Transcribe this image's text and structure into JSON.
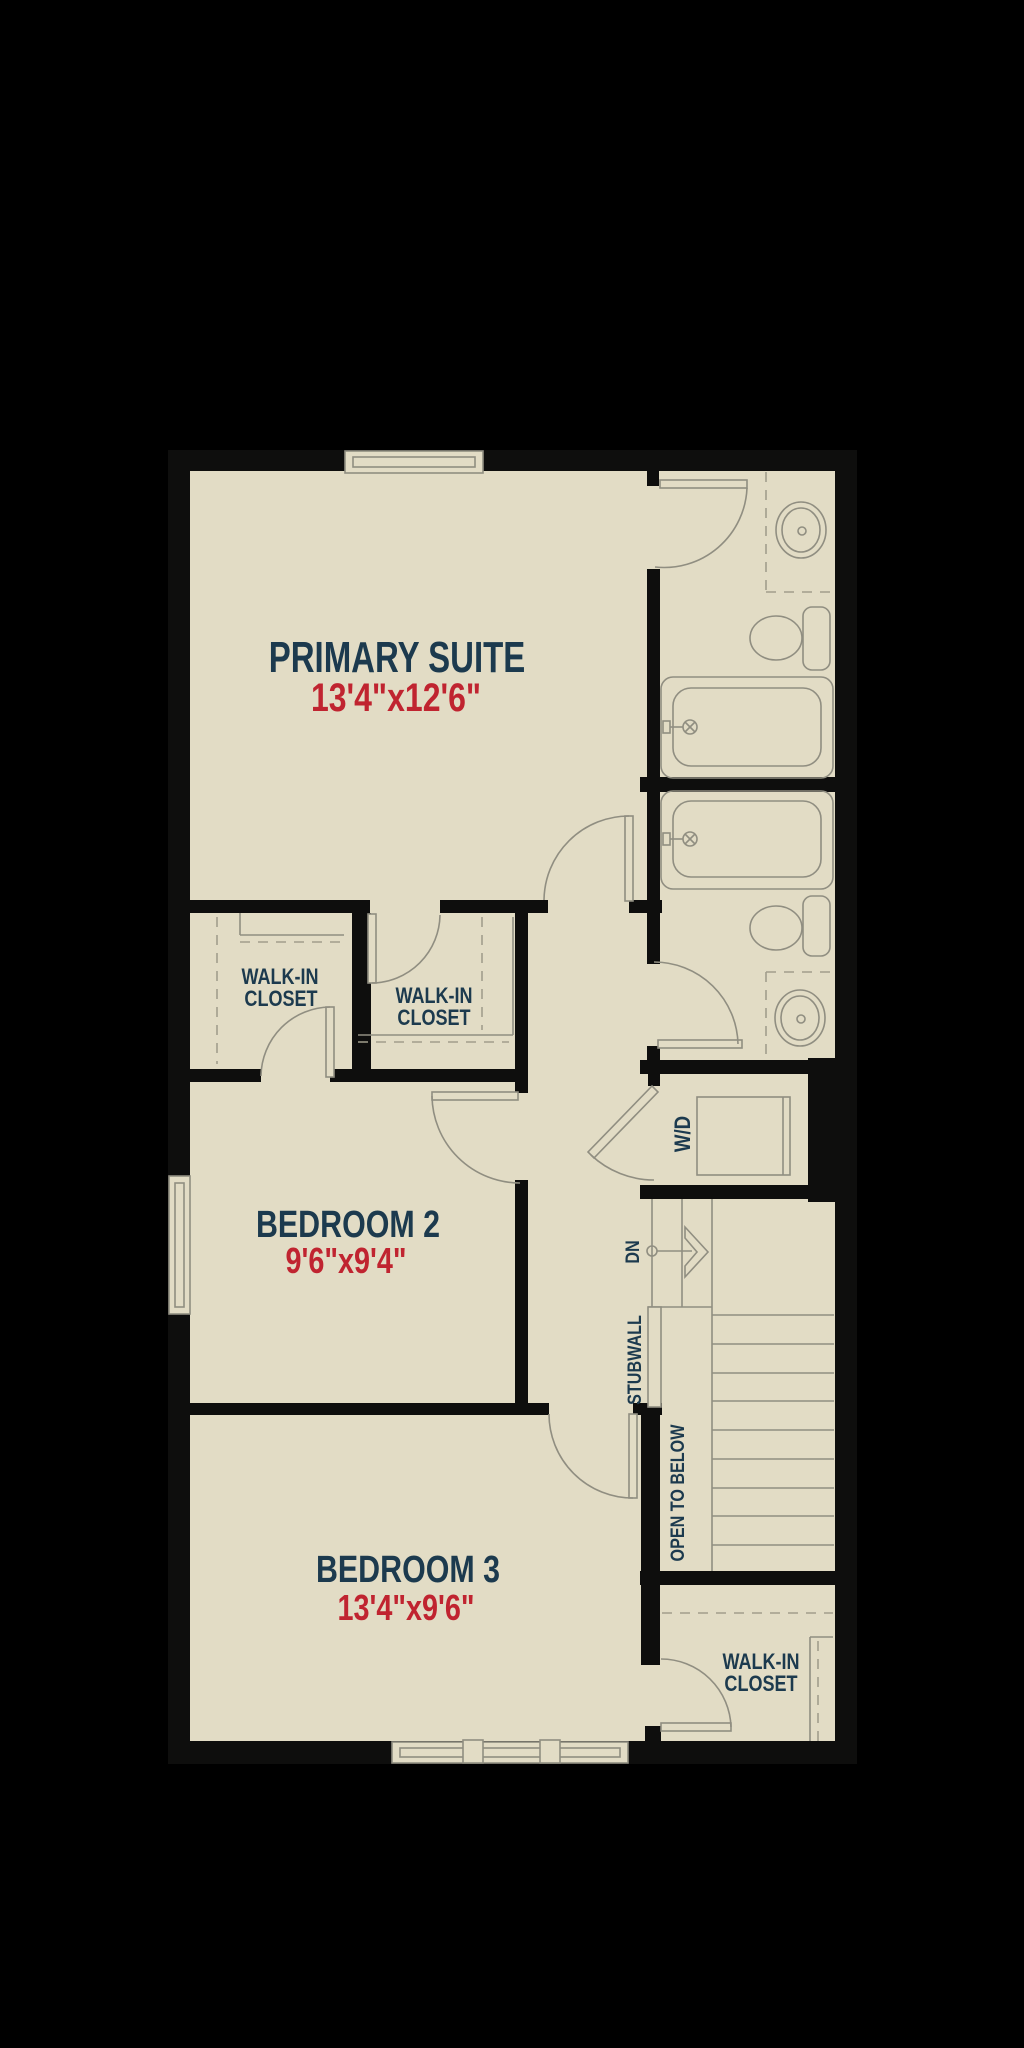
{
  "rooms": {
    "primary_suite": {
      "label": "PRIMARY SUITE",
      "dims": "13'4\"x12'6\""
    },
    "bedroom_2": {
      "label": "BEDROOM 2",
      "dims": "9'6\"x9'4\""
    },
    "bedroom_3": {
      "label": "BEDROOM 3",
      "dims": "13'4\"x9'6\""
    },
    "closet_bedroom2": {
      "line1": "WALK-IN",
      "line2": "CLOSET"
    },
    "closet_primary": {
      "line1": "WALK-IN",
      "line2": "CLOSET"
    },
    "closet_lower": {
      "line1": "WALK-IN",
      "line2": "CLOSET"
    }
  },
  "annotations": {
    "laundry": "W/D",
    "stairs_direction": "DN",
    "stubwall": "STUBWALL",
    "open_to_below": "OPEN TO BELOW"
  },
  "colors": {
    "background": "#000000",
    "floor": "#e2dcc5",
    "wall": "#0e0e0d",
    "room_label": "#1c3a4e",
    "dimension_label": "#c02430",
    "fixture_line": "#908e81"
  }
}
